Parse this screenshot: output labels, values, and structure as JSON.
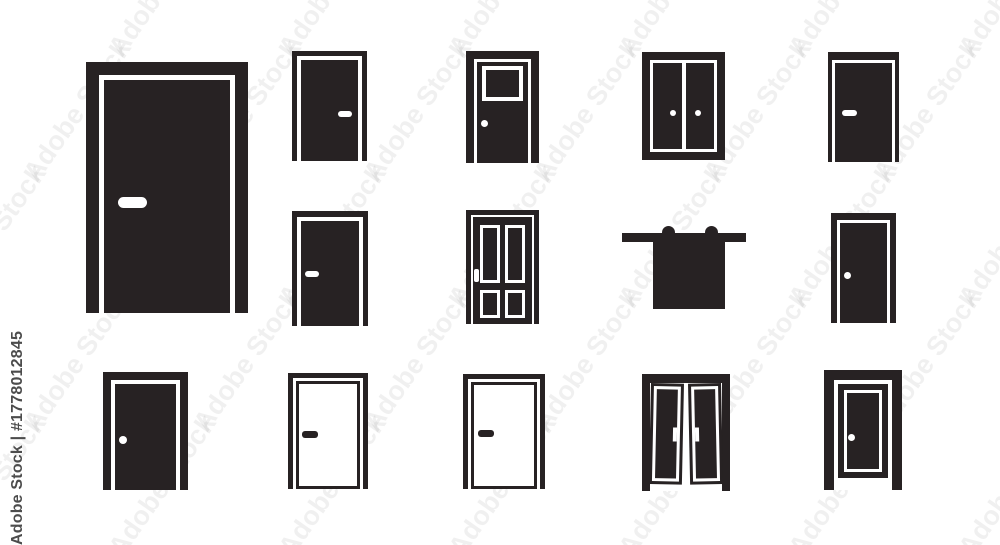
{
  "image": {
    "type": "stock-image-preview",
    "subject": "Door icons set - black flat vector doors on white background"
  },
  "watermark": {
    "credit": "Adobe Stock | #1778012845",
    "tile_text": "Adobe Stock"
  },
  "colors": {
    "icon_ink": "#272223",
    "credit_text": "#4c4c4c",
    "background": "#ffffff",
    "tile_opacity": 0.055
  },
  "icons": [
    {
      "name": "large-single-door-icon",
      "description": "large closed door in frame with white bar handle",
      "row": 1,
      "col": 1
    },
    {
      "name": "single-door-right-handle-icon",
      "description": "closed door, white handle on right",
      "row": 1,
      "col": 2
    },
    {
      "name": "door-with-window-icon",
      "description": "door with top window and round knob",
      "row": 1,
      "col": 3
    },
    {
      "name": "double-door-icon",
      "description": "double door, two round knobs",
      "row": 1,
      "col": 4
    },
    {
      "name": "single-door-left-handle-icon",
      "description": "closed door, white handle on left",
      "row": 1,
      "col": 5
    },
    {
      "name": "single-door-left-handle-icon",
      "description": "closed door, white handle on left",
      "row": 2,
      "col": 2
    },
    {
      "name": "four-panel-door-icon",
      "description": "door with four inset panels and latch",
      "row": 2,
      "col": 3
    },
    {
      "name": "sliding-barn-door-icon",
      "description": "sliding barn door hanging from top rail",
      "row": 2,
      "col": 4
    },
    {
      "name": "door-with-knob-icon",
      "description": "closed door with round knob",
      "row": 2,
      "col": 5
    },
    {
      "name": "door-with-knob-icon",
      "description": "closed door with round knob",
      "row": 3,
      "col": 1
    },
    {
      "name": "white-door-outline-icon",
      "description": "outline door, dark handle on left",
      "row": 3,
      "col": 2
    },
    {
      "name": "white-door-outline-icon",
      "description": "outline door, dark handle on left",
      "row": 3,
      "col": 3
    },
    {
      "name": "folding-double-door-icon",
      "description": "folding double door with inset outlines",
      "row": 3,
      "col": 4
    },
    {
      "name": "double-framed-door-icon",
      "description": "door with double frame and round knob",
      "row": 3,
      "col": 5
    }
  ]
}
